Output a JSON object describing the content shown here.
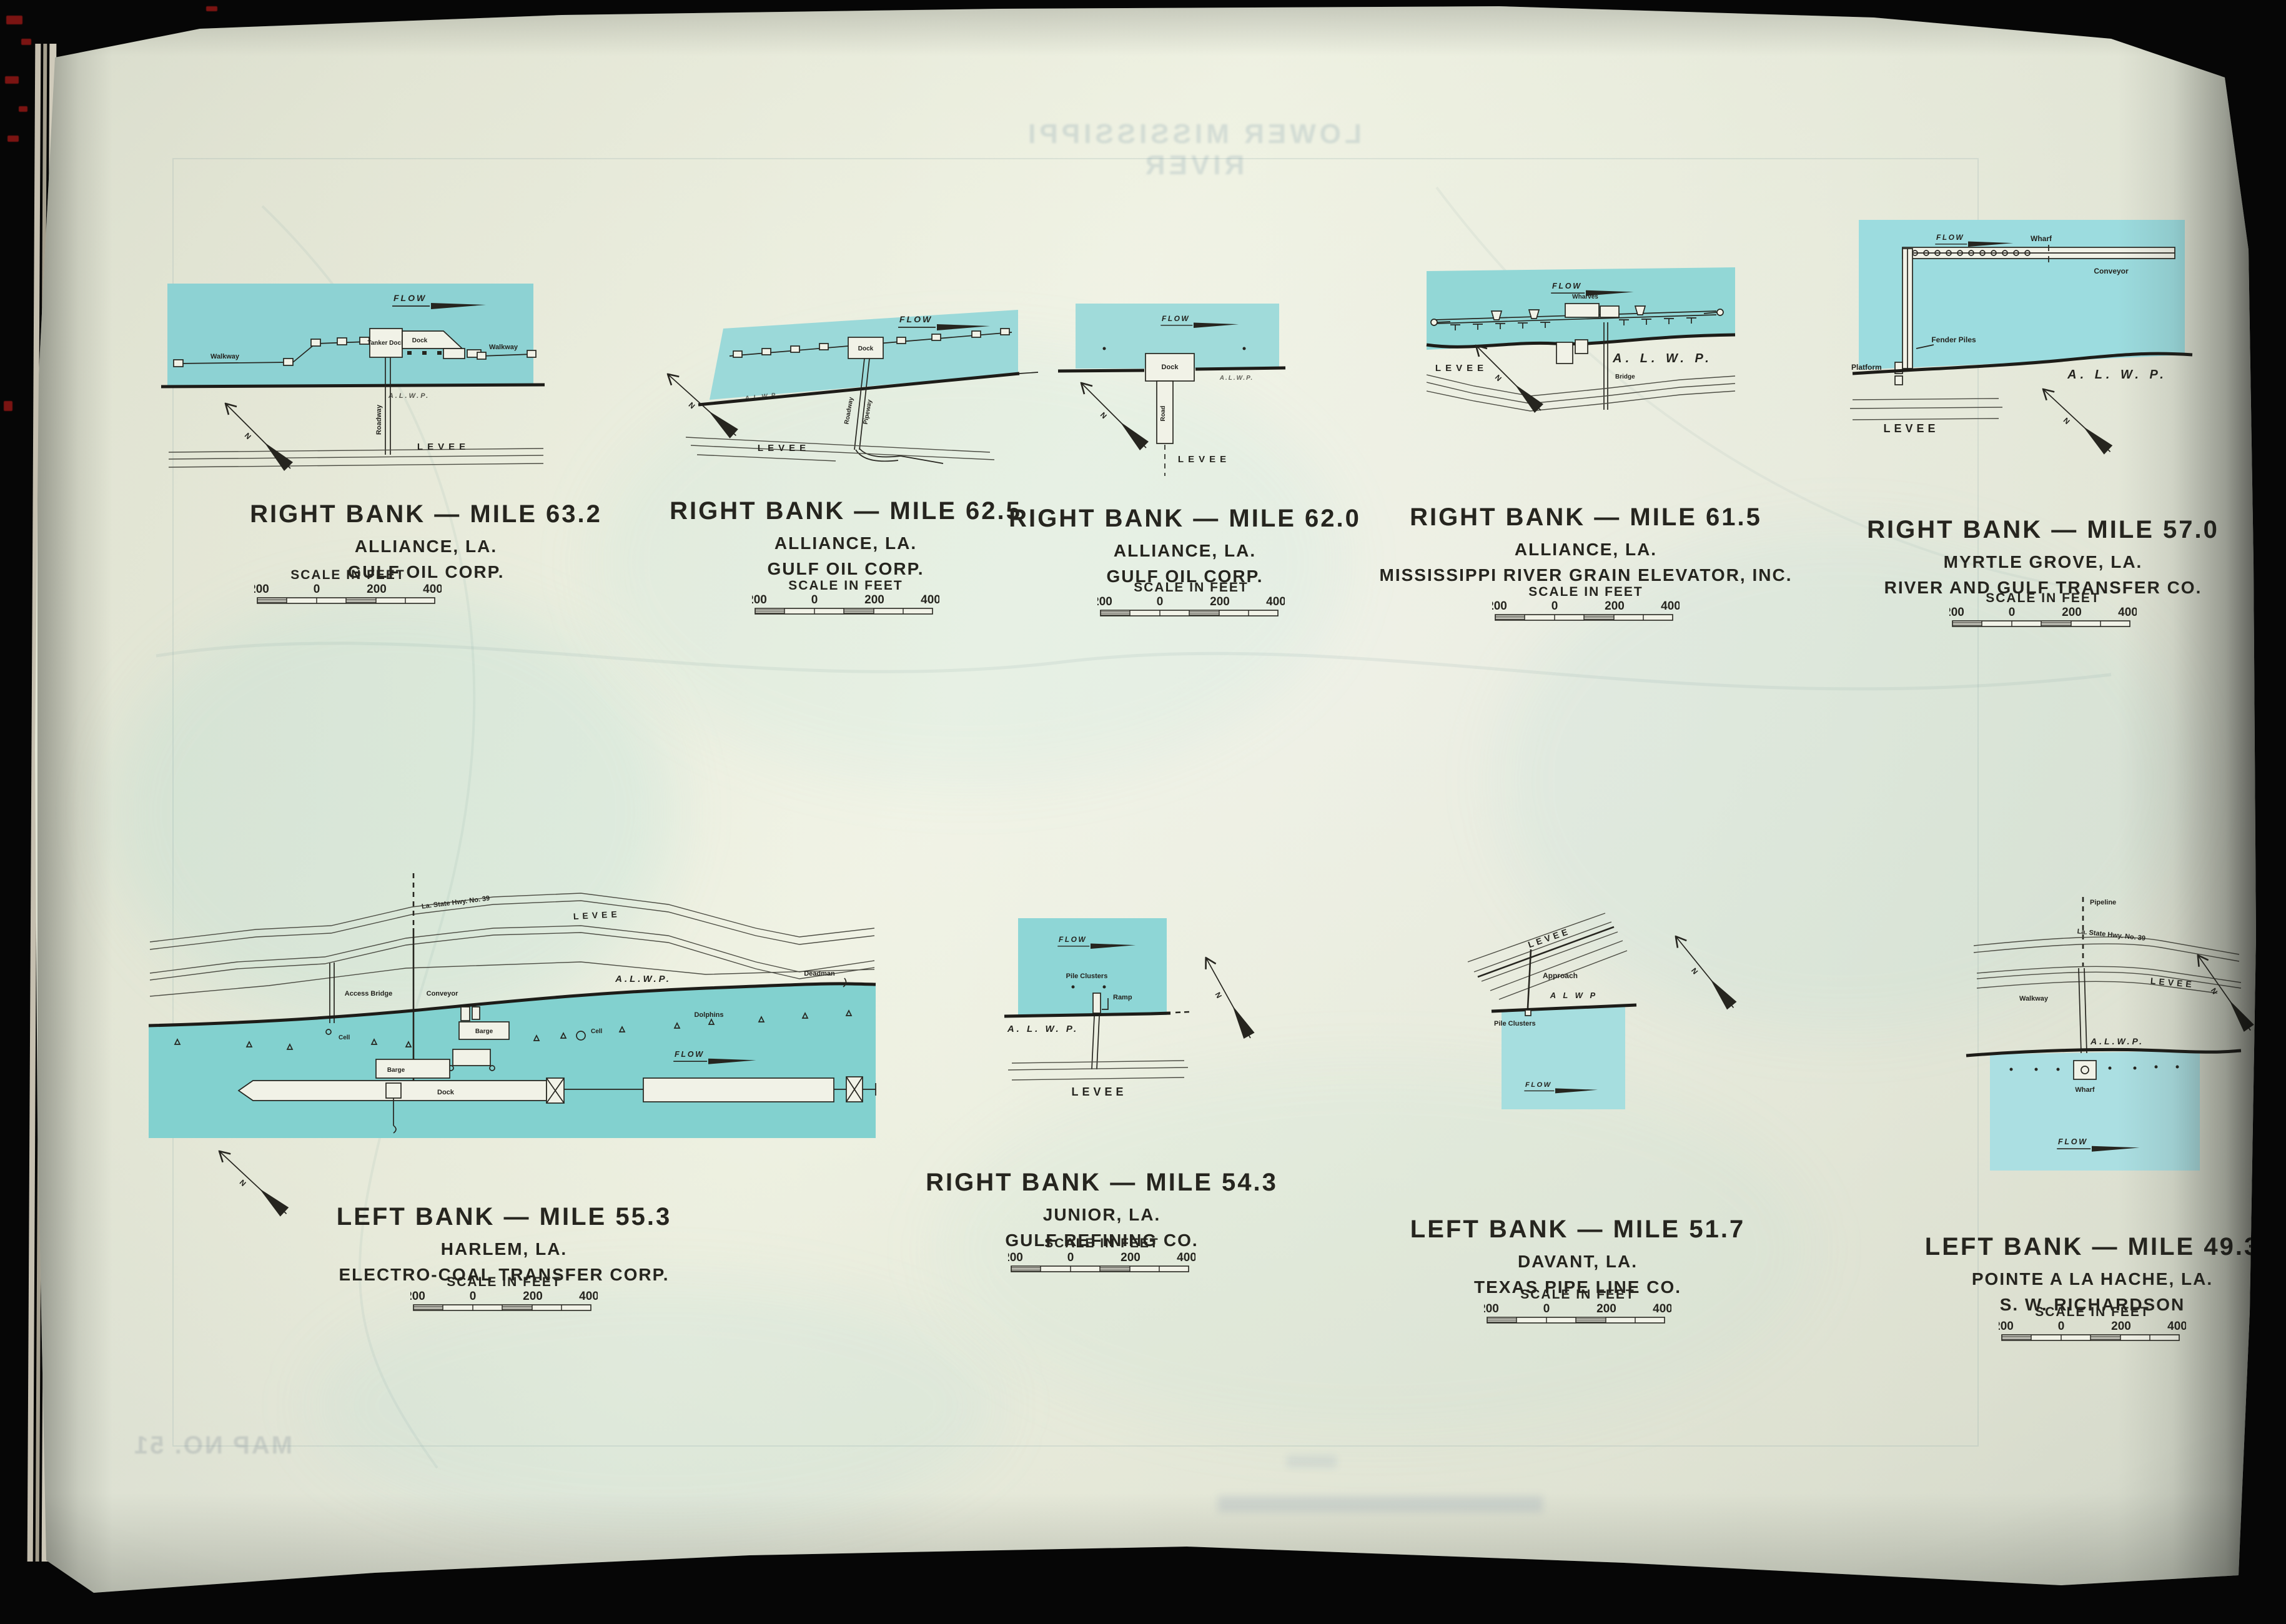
{
  "palette": {
    "page": "#eef1e2",
    "water": "#8fd4d4",
    "ink": "#26251f",
    "background": "#060606"
  },
  "bleedthrough": {
    "top_title": "LOWER MISSISSIPPI RIVER",
    "map_no": "MAP NO. 51"
  },
  "compass": {
    "north": "N"
  },
  "scale": {
    "title": "SCALE IN FEET",
    "ticks": [
      "200",
      "0",
      "200",
      "400"
    ]
  },
  "panels": [
    {
      "id": "mile-63.2",
      "title": {
        "bank_mile": "RIGHT BANK — MILE 63.2",
        "place": "ALLIANCE, LA.",
        "company": "GULF OIL CORP."
      },
      "labels": {
        "flow": "FLOW",
        "walkway_left": "Walkway",
        "tanker_dock": "Tanker Dock",
        "dock": "Dock",
        "walkway_right": "Walkway",
        "roadway": "Roadway",
        "alwp": "A.L.W.P.",
        "levee": "LEVEE"
      }
    },
    {
      "id": "mile-62.5",
      "title": {
        "bank_mile": "RIGHT BANK — MILE 62.5",
        "place": "ALLIANCE, LA.",
        "company": "GULF OIL CORP."
      },
      "labels": {
        "flow": "FLOW",
        "dock": "Dock",
        "roadway": "Roadway",
        "pipeway": "Pipeway",
        "alwp": "A.L.W.P.",
        "levee": "LEVEE"
      }
    },
    {
      "id": "mile-62.0",
      "title": {
        "bank_mile": "RIGHT BANK — MILE 62.0",
        "place": "ALLIANCE, LA.",
        "company": "GULF OIL CORP."
      },
      "labels": {
        "flow": "FLOW",
        "dock": "Dock",
        "road": "Road",
        "levee": "LEVEE",
        "alwp": "A.L.W.P."
      }
    },
    {
      "id": "mile-61.5",
      "title": {
        "bank_mile": "RIGHT BANK — MILE 61.5",
        "place": "ALLIANCE, LA.",
        "company": "MISSISSIPPI RIVER GRAIN ELEVATOR, INC."
      },
      "labels": {
        "flow": "FLOW",
        "wharves": "Wharves",
        "bridge": "Bridge",
        "levee": "LEVEE",
        "alwp": "A. L. W. P."
      }
    },
    {
      "id": "mile-57.0",
      "title": {
        "bank_mile": "RIGHT BANK — MILE 57.0",
        "place": "MYRTLE GROVE, LA.",
        "company": "RIVER AND GULF TRANSFER CO."
      },
      "labels": {
        "flow": "FLOW",
        "wharf": "Wharf",
        "conveyor": "Conveyor",
        "fender_piles": "Fender Piles",
        "platform": "Platform",
        "alwp": "A. L. W. P.",
        "levee": "LEVEE"
      }
    },
    {
      "id": "mile-55.3",
      "title": {
        "bank_mile": "LEFT BANK — MILE 55.3",
        "place": "HARLEM, LA.",
        "company": "ELECTRO-COAL TRANSFER CORP."
      },
      "labels": {
        "hwy": "La. State Hwy. No. 39",
        "levee": "LEVEE",
        "access_bridge": "Access Bridge",
        "conveyor": "Conveyor",
        "cell_left": "Cell",
        "cell_mid": "Cell",
        "dolphins": "Dolphins",
        "deadman": "Deadman",
        "barge_upper": "Barge",
        "barge_lower": "Barge",
        "dock": "Dock",
        "alwp": "A.L.W.P.",
        "flow": "FLOW"
      }
    },
    {
      "id": "mile-54.3",
      "title": {
        "bank_mile": "RIGHT BANK — MILE 54.3",
        "place": "JUNIOR, LA.",
        "company": "GULF REFINING CO."
      },
      "labels": {
        "flow": "FLOW",
        "pile_clusters": "Pile Clusters",
        "ramp": "Ramp",
        "alwp": "A. L. W. P.",
        "levee": "LEVEE"
      }
    },
    {
      "id": "mile-51.7",
      "title": {
        "bank_mile": "LEFT BANK — MILE 51.7",
        "place": "DAVANT, LA.",
        "company": "TEXAS PIPE LINE CO."
      },
      "labels": {
        "levee": "LEVEE",
        "approach": "Approach",
        "alwp": "A L W P",
        "pile_clusters": "Pile Clusters",
        "flow": "FLOW"
      }
    },
    {
      "id": "mile-49.3",
      "title": {
        "bank_mile": "LEFT BANK — MILE 49.3",
        "place": "POINTE A LA HACHE, LA.",
        "company": "S. W. RICHARDSON"
      },
      "labels": {
        "pipeline": "Pipeline",
        "hwy": "La. State Hwy. No. 39",
        "levee": "LEVEE",
        "walkway": "Walkway",
        "alwp": "A.L.W.P.",
        "wharf": "Wharf",
        "flow": "FLOW"
      }
    }
  ]
}
